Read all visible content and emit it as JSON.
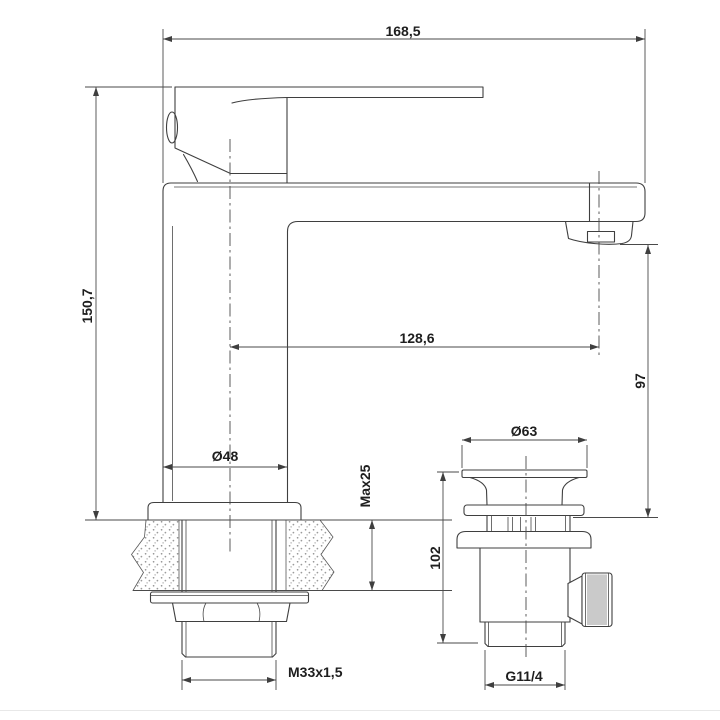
{
  "drawing": {
    "type": "technical-dimension-drawing",
    "subject": "basin mixer faucet side view with countertop cross-section and pop-up waste valve",
    "background": "#ffffff",
    "line_color": "#3f3f3f",
    "text_color": "#1e1e1e",
    "labels": {
      "width_total": "168,5",
      "height_total": "150,7",
      "spout_reach": "128,6",
      "spout_height": "97",
      "body_diameter": "Ø48",
      "deck_max_thickness": "Max25",
      "mounting_thread": "M33x1,5",
      "waste_flange_diameter": "Ø63",
      "waste_body_height": "102",
      "waste_thread": "G11/4"
    }
  }
}
